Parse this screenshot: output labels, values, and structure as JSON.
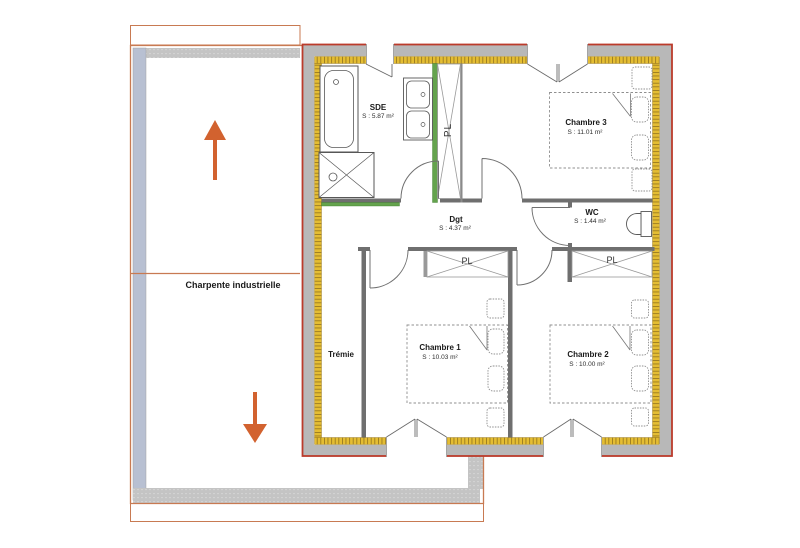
{
  "annex": {
    "label": "Charpente industrielle",
    "icons": {
      "top": "up-arrow",
      "bottom": "down-arrow"
    }
  },
  "plan": {
    "rooms": [
      {
        "name": "SDE",
        "area": "S : 5.87 m²"
      },
      {
        "name": "Chambre 3",
        "area": "S : 11.01 m²"
      },
      {
        "name": "Dgt",
        "area": "S : 4.37 m²"
      },
      {
        "name": "WC",
        "area": "S : 1.44 m²"
      },
      {
        "name": "Chambre 1",
        "area": "S : 10.03 m²"
      },
      {
        "name": "Chambre 2",
        "area": "S : 10.00 m²"
      }
    ],
    "tremie_label": "Trémie",
    "closets": {
      "hall": "PL",
      "chambre1": "PL",
      "chambre2": "PL"
    }
  },
  "colors": {
    "plan_outline": "#bb3b2b",
    "annex_outline": "#c87a52",
    "wall_fill": "#b8b8b8",
    "insulation": "#e4bd33",
    "green_partition": "#64a34d",
    "arrow": "#d2622f"
  }
}
